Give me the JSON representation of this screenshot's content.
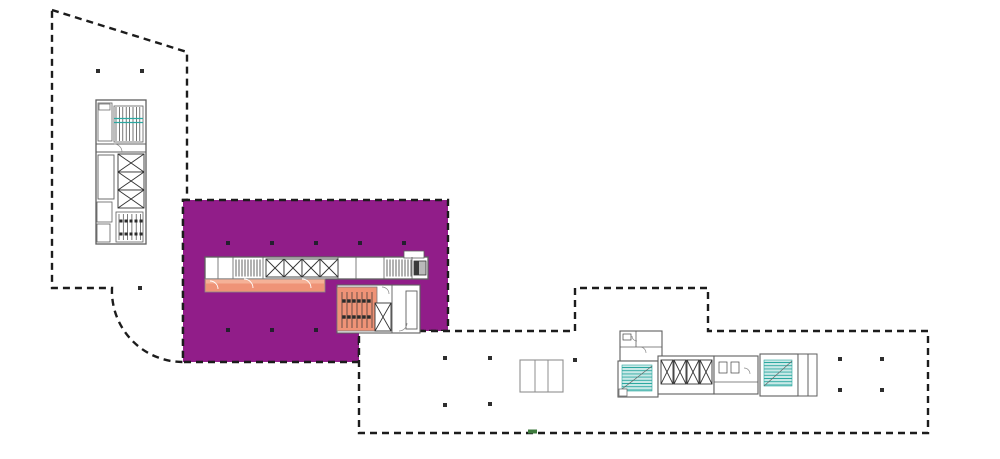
{
  "canvas": {
    "width": 1000,
    "height": 459,
    "background": "#ffffff"
  },
  "palette": {
    "purple": "#911d89",
    "orange": "#ef9377",
    "orange_light": "#f5b197",
    "teal": "#2ba8a0",
    "teal_light": "#c9e9e7",
    "wall": "#5f5f5f",
    "outline": "#1c1c1c",
    "column": "#2e2e2e",
    "green": "#3d7a3c",
    "lightline": "#8f8f8f"
  },
  "regions": {
    "west_wing": {
      "kind": "building-footprint",
      "fill": "#ffffff"
    },
    "highlighted_suite": {
      "kind": "highlight-zone",
      "fill": "#911d89"
    },
    "east_wing": {
      "kind": "building-footprint",
      "fill": "#ffffff"
    },
    "corridor_highlight": {
      "kind": "highlight-zone",
      "fill": "#ef9377"
    },
    "stall_room_highlight": {
      "kind": "highlight-zone",
      "fill": "#ef9377"
    }
  },
  "shapes": [
    {
      "name": "building-west-wing",
      "i": false,
      "t": "path",
      "d": "M52,10 L187,52 L187,200 L183,200 L183,362 A71,71 0 0 1 112,288 L52,288 Z",
      "f": "#ffffff",
      "k": "$outline",
      "sw": 2.4,
      "da": "7 5"
    },
    {
      "name": "highlight-zone-purple",
      "i": true,
      "t": "path",
      "d": "M183,200 L448,200 L448,331 L359,331 L359,362 L183,362 Z",
      "f": "$purple",
      "k": "$outline",
      "sw": 2.4,
      "da": "7 5"
    },
    {
      "name": "building-east-wing",
      "i": false,
      "t": "path",
      "d": "M359,331 L575,331 L575,288 L708,288 L708,331 L928,331 L928,433 L359,433 Z",
      "f": "#ffffff",
      "k": "$outline",
      "sw": 2.4,
      "da": "7 5"
    },
    {
      "name": "shaft-triplet",
      "i": false,
      "t": "rect",
      "x": 520,
      "y": 360,
      "w": 43,
      "h": 32,
      "f": "#ffffff",
      "k": "$lightline",
      "sw": 1.1
    },
    {
      "name": "shaft-triplet-divider",
      "i": false,
      "t": "line",
      "x1": 535,
      "y1": 360,
      "x2": 535,
      "y2": 392,
      "k": "$lightline",
      "sw": 1
    },
    {
      "name": "shaft-triplet-divider",
      "i": false,
      "t": "line",
      "x1": 548,
      "y1": 360,
      "x2": 548,
      "y2": 392,
      "k": "$lightline",
      "sw": 1
    },
    {
      "name": "central-core-band",
      "i": false,
      "t": "rect",
      "x": 205,
      "y": 257,
      "w": 223,
      "h": 22,
      "f": "#ffffff",
      "k": "$wall",
      "sw": 1.3
    },
    {
      "name": "central-core-tab",
      "i": false,
      "t": "rect",
      "x": 404,
      "y": 251,
      "w": 20,
      "h": 7,
      "f": "#ffffff",
      "k": "$wall",
      "sw": 0.8
    },
    {
      "name": "core-partition",
      "i": false,
      "t": "line",
      "x1": 218,
      "y1": 257,
      "x2": 218,
      "y2": 279,
      "k": "$wall",
      "sw": 0.8
    },
    {
      "name": "core-partition",
      "i": false,
      "t": "line",
      "x1": 233,
      "y1": 257,
      "x2": 233,
      "y2": 279,
      "k": "$wall",
      "sw": 0.8
    },
    {
      "name": "core-partition",
      "i": false,
      "t": "line",
      "x1": 263,
      "y1": 257,
      "x2": 263,
      "y2": 279,
      "k": "$wall",
      "sw": 0.8
    },
    {
      "name": "core-partition",
      "i": false,
      "t": "line",
      "x1": 338,
      "y1": 257,
      "x2": 338,
      "y2": 279,
      "k": "$wall",
      "sw": 0.8
    },
    {
      "name": "core-partition",
      "i": false,
      "t": "line",
      "x1": 356,
      "y1": 257,
      "x2": 356,
      "y2": 279,
      "k": "$wall",
      "sw": 0.8
    },
    {
      "name": "core-partition",
      "i": false,
      "t": "line",
      "x1": 384,
      "y1": 257,
      "x2": 384,
      "y2": 279,
      "k": "$wall",
      "sw": 0.8
    },
    {
      "name": "core-partition",
      "i": false,
      "t": "line",
      "x1": 412,
      "y1": 257,
      "x2": 412,
      "y2": 279,
      "k": "$wall",
      "sw": 0.8
    },
    {
      "name": "stair-hatch",
      "i": false,
      "t": "vl",
      "x": 236,
      "y": 259.5,
      "h": 17,
      "n": 9,
      "s": 3,
      "k": "#3c3c3c",
      "sw": 0.8
    },
    {
      "name": "elevator-cell",
      "i": false,
      "t": "xr",
      "x": 266,
      "y": 259,
      "w": 18,
      "h": 18,
      "f": "#ffffff",
      "k": "#333333",
      "sw": 0.9
    },
    {
      "name": "elevator-cell",
      "i": false,
      "t": "xr",
      "x": 284,
      "y": 259,
      "w": 18,
      "h": 18,
      "f": "#ffffff",
      "k": "#333333",
      "sw": 0.9
    },
    {
      "name": "elevator-cell",
      "i": false,
      "t": "xr",
      "x": 302,
      "y": 259,
      "w": 18,
      "h": 18,
      "f": "#ffffff",
      "k": "#333333",
      "sw": 0.9
    },
    {
      "name": "elevator-cell",
      "i": false,
      "t": "xr",
      "x": 320,
      "y": 259,
      "w": 18,
      "h": 18,
      "f": "#ffffff",
      "k": "#333333",
      "sw": 0.9
    },
    {
      "name": "stair-hatch",
      "i": false,
      "t": "vl",
      "x": 387,
      "y": 259.5,
      "h": 17,
      "n": 9,
      "s": 3,
      "k": "#3c3c3c",
      "sw": 0.8
    },
    {
      "name": "service-shaft",
      "i": false,
      "t": "rect",
      "x": 414,
      "y": 261,
      "w": 12,
      "h": 14,
      "f": "#b9b9b9",
      "k": "#333333",
      "sw": 0.8
    },
    {
      "name": "service-shaft-dark",
      "i": false,
      "t": "rect",
      "x": 414,
      "y": 261,
      "w": 5,
      "h": 14,
      "f": "#3a3a3a"
    },
    {
      "name": "corridor-highlight-orange",
      "i": true,
      "t": "rect",
      "x": 205,
      "y": 279,
      "w": 120,
      "h": 13,
      "f": "$orange",
      "k": "#8a8a8a",
      "sw": 0.8
    },
    {
      "name": "corridor-highlight-light",
      "i": false,
      "t": "rect",
      "x": 206,
      "y": 279.5,
      "w": 118,
      "h": 4,
      "f": "$orange_light"
    },
    {
      "name": "door-arc",
      "i": false,
      "t": "path",
      "d": "M210,281 a8,8 0 0 1 8,8",
      "k": "#ffffff",
      "sw": 0.9
    },
    {
      "name": "door-arc",
      "i": false,
      "t": "path",
      "d": "M244,279 a9,9 0 0 1 9,9",
      "k": "#ffffff",
      "sw": 0.9
    },
    {
      "name": "door-arc",
      "i": false,
      "t": "path",
      "d": "M302,279 a9,9 0 0 1 9,9",
      "k": "#ffffff",
      "sw": 0.9
    },
    {
      "name": "lower-core-cluster",
      "i": false,
      "t": "rect",
      "x": 337,
      "y": 285,
      "w": 83,
      "h": 48,
      "f": "#ffffff",
      "k": "$wall",
      "sw": 1.1
    },
    {
      "name": "stall-room-highlight-orange",
      "i": true,
      "t": "rect",
      "x": 337,
      "y": 287,
      "w": 40,
      "h": 44,
      "f": "$orange",
      "k": "#7a7a7a",
      "sw": 0.8
    },
    {
      "name": "stall-partitions",
      "i": false,
      "t": "vl",
      "x": 342,
      "y": 292,
      "h": 36,
      "n": 7,
      "s": 5,
      "k": "#333333",
      "sw": 0.7
    },
    {
      "name": "stall-fixtures",
      "i": false,
      "t": "dots",
      "pts": [
        [
          344,
          301
        ],
        [
          349,
          301
        ],
        [
          354,
          301
        ],
        [
          359,
          301
        ],
        [
          364,
          301
        ],
        [
          369,
          301
        ],
        [
          344,
          317
        ],
        [
          349,
          317
        ],
        [
          354,
          317
        ],
        [
          359,
          317
        ],
        [
          364,
          317
        ],
        [
          369,
          317
        ]
      ],
      "s": 3.4,
      "f": "#2b2b2b"
    },
    {
      "name": "stair-shaft",
      "i": false,
      "t": "xr",
      "x": 375,
      "y": 303,
      "w": 16,
      "h": 28,
      "f": "#ffffff",
      "k": "#333333",
      "sw": 0.9
    },
    {
      "name": "core-partition",
      "i": false,
      "t": "line",
      "x1": 392,
      "y1": 285,
      "x2": 392,
      "y2": 333,
      "k": "$wall",
      "sw": 0.9
    },
    {
      "name": "core-corridor",
      "i": false,
      "t": "rect",
      "x": 406,
      "y": 291,
      "w": 11,
      "h": 38,
      "f": "#ffffff",
      "k": "$wall",
      "sw": 0.9
    },
    {
      "name": "door-arc",
      "i": false,
      "t": "path",
      "d": "M382,287 a7,7 0 0 1 7,7",
      "k": "#888888",
      "sw": 0.7
    },
    {
      "name": "door-arc",
      "i": false,
      "t": "path",
      "d": "M399,331 a8,8 0 0 0 8,-8",
      "k": "#888888",
      "sw": 0.7
    },
    {
      "name": "west-core",
      "i": false,
      "t": "rect",
      "x": 96,
      "y": 100,
      "w": 50,
      "h": 144,
      "f": "#ffffff",
      "k": "$wall",
      "sw": 1.3
    },
    {
      "name": "core-partition",
      "i": false,
      "t": "line",
      "x1": 96,
      "y1": 144,
      "x2": 146,
      "y2": 144,
      "k": "$wall",
      "sw": 0.9
    },
    {
      "name": "core-partition",
      "i": false,
      "t": "line",
      "x1": 96,
      "y1": 152,
      "x2": 146,
      "y2": 152,
      "k": "$wall",
      "sw": 0.9
    },
    {
      "name": "west-core-room",
      "i": false,
      "t": "rect",
      "x": 98,
      "y": 103,
      "w": 14,
      "h": 38,
      "k": "$wall",
      "sw": 0.8
    },
    {
      "name": "west-core-cabinet",
      "i": false,
      "t": "rect",
      "x": 99,
      "y": 104,
      "w": 11,
      "h": 6,
      "k": "$wall",
      "sw": 0.7
    },
    {
      "name": "stair-room",
      "i": false,
      "t": "rect",
      "x": 114,
      "y": 106,
      "w": 29,
      "h": 36,
      "k": "$wall",
      "sw": 0.8
    },
    {
      "name": "stair-hatch",
      "i": false,
      "t": "vl",
      "x": 116,
      "y": 107,
      "h": 34,
      "n": 8,
      "s": 3.4,
      "k": "#3c3c3c",
      "sw": 0.7
    },
    {
      "name": "stair-tread-teal",
      "i": false,
      "t": "line",
      "x1": 114,
      "y1": 118.5,
      "x2": 143,
      "y2": 118.5,
      "k": "$teal",
      "sw": 1.3
    },
    {
      "name": "stair-tread-teal",
      "i": false,
      "t": "line",
      "x1": 114,
      "y1": 122.5,
      "x2": 143,
      "y2": 122.5,
      "k": "$teal",
      "sw": 1.3
    },
    {
      "name": "door-arc",
      "i": false,
      "t": "path",
      "d": "M114,144 a8,8 0 0 1 8,8",
      "k": "#888888",
      "sw": 0.7
    },
    {
      "name": "west-core-room",
      "i": false,
      "t": "rect",
      "x": 98,
      "y": 155,
      "w": 16,
      "h": 44,
      "k": "$wall",
      "sw": 0.9
    },
    {
      "name": "elevator-cell",
      "i": false,
      "t": "xr",
      "x": 118,
      "y": 154,
      "w": 26,
      "h": 18,
      "f": "#ffffff",
      "k": "#333333",
      "sw": 0.9
    },
    {
      "name": "elevator-cell",
      "i": false,
      "t": "xr",
      "x": 118,
      "y": 172,
      "w": 26,
      "h": 18,
      "f": "#ffffff",
      "k": "#333333",
      "sw": 0.9
    },
    {
      "name": "elevator-cell",
      "i": false,
      "t": "xr",
      "x": 118,
      "y": 190,
      "w": 26,
      "h": 18,
      "f": "#ffffff",
      "k": "#333333",
      "sw": 0.9
    },
    {
      "name": "west-core-room",
      "i": false,
      "t": "rect",
      "x": 97,
      "y": 202,
      "w": 15,
      "h": 20,
      "k": "$wall",
      "sw": 0.8
    },
    {
      "name": "west-core-room",
      "i": false,
      "t": "rect",
      "x": 97,
      "y": 224,
      "w": 13,
      "h": 18,
      "k": "$wall",
      "sw": 0.8
    },
    {
      "name": "stall-room",
      "i": false,
      "t": "rect",
      "x": 116,
      "y": 212,
      "w": 27,
      "h": 30,
      "k": "$wall",
      "sw": 0.8
    },
    {
      "name": "stall-partitions",
      "i": false,
      "t": "vl",
      "x": 119,
      "y": 214,
      "h": 26,
      "n": 6,
      "s": 4.3,
      "k": "#444444",
      "sw": 0.7
    },
    {
      "name": "stall-fixtures",
      "i": false,
      "t": "dots",
      "pts": [
        [
          121,
          221
        ],
        [
          126,
          221
        ],
        [
          131,
          221
        ],
        [
          136,
          221
        ],
        [
          141,
          221
        ],
        [
          121,
          234
        ],
        [
          126,
          234
        ],
        [
          131,
          234
        ],
        [
          136,
          234
        ],
        [
          141,
          234
        ]
      ],
      "s": 3,
      "f": "#2b2b2b"
    },
    {
      "name": "east-core-rooms",
      "i": false,
      "t": "rect",
      "x": 620,
      "y": 331,
      "w": 42,
      "h": 30,
      "f": "#ffffff",
      "k": "$wall",
      "sw": 1.1
    },
    {
      "name": "core-partition",
      "i": false,
      "t": "line",
      "x1": 636,
      "y1": 331,
      "x2": 636,
      "y2": 347,
      "k": "$wall",
      "sw": 0.8
    },
    {
      "name": "core-partition",
      "i": false,
      "t": "line",
      "x1": 620,
      "y1": 347,
      "x2": 662,
      "y2": 347,
      "k": "$wall",
      "sw": 0.8
    },
    {
      "name": "fixture",
      "i": false,
      "t": "rect",
      "x": 623,
      "y": 334,
      "w": 8,
      "h": 6,
      "k": "#444444",
      "sw": 0.7
    },
    {
      "name": "door-arc",
      "i": false,
      "t": "path",
      "d": "M640,347 a6,6 0 0 1 6,6",
      "k": "#888888",
      "sw": 0.7
    },
    {
      "name": "door-arc",
      "i": false,
      "t": "path",
      "d": "M632,336 a5,5 0 0 0 5,5",
      "k": "#888888",
      "sw": 0.7
    },
    {
      "name": "stair-room",
      "i": false,
      "t": "rect",
      "x": 618,
      "y": 361,
      "w": 40,
      "h": 36,
      "f": "#ffffff",
      "k": "$wall",
      "sw": 1.1
    },
    {
      "name": "stair-teal-block",
      "i": false,
      "t": "rect",
      "x": 622,
      "y": 365,
      "w": 30,
      "h": 26,
      "f": "$teal_light",
      "k": "$teal",
      "sw": 0.6
    },
    {
      "name": "stair-treads-teal",
      "i": false,
      "t": "hl",
      "x": 622,
      "y": 367.5,
      "w": 30,
      "n": 8,
      "s": 3.2,
      "k": "$teal",
      "sw": 0.9
    },
    {
      "name": "stair-diagonal",
      "i": false,
      "t": "line",
      "x1": 622,
      "y1": 389,
      "x2": 652,
      "y2": 366,
      "k": "#666666",
      "sw": 0.7
    },
    {
      "name": "east-core-closet",
      "i": false,
      "t": "rect",
      "x": 619,
      "y": 389,
      "w": 8,
      "h": 7,
      "f": "#ffffff",
      "k": "$wall",
      "sw": 0.7
    },
    {
      "name": "elevator-lobby",
      "i": false,
      "t": "rect",
      "x": 658,
      "y": 356,
      "w": 56,
      "h": 38,
      "f": "#ffffff",
      "k": "$wall",
      "sw": 1.1
    },
    {
      "name": "elevator-cell",
      "i": false,
      "t": "xr",
      "x": 661,
      "y": 360,
      "w": 12,
      "h": 24,
      "f": "#ffffff",
      "k": "#333333",
      "sw": 0.9
    },
    {
      "name": "elevator-cell",
      "i": false,
      "t": "xr",
      "x": 674,
      "y": 360,
      "w": 12,
      "h": 24,
      "f": "#ffffff",
      "k": "#333333",
      "sw": 0.9
    },
    {
      "name": "elevator-cell",
      "i": false,
      "t": "xr",
      "x": 687,
      "y": 360,
      "w": 12,
      "h": 24,
      "f": "#ffffff",
      "k": "#333333",
      "sw": 0.9
    },
    {
      "name": "elevator-cell",
      "i": false,
      "t": "xr",
      "x": 700,
      "y": 360,
      "w": 12,
      "h": 24,
      "f": "#ffffff",
      "k": "#333333",
      "sw": 0.9
    },
    {
      "name": "restroom",
      "i": false,
      "t": "rect",
      "x": 714,
      "y": 356,
      "w": 44,
      "h": 38,
      "f": "#ffffff",
      "k": "$wall",
      "sw": 1.1
    },
    {
      "name": "core-partition",
      "i": false,
      "t": "line",
      "x1": 714,
      "y1": 382,
      "x2": 758,
      "y2": 382,
      "k": "$wall",
      "sw": 0.7
    },
    {
      "name": "fixture",
      "i": false,
      "t": "rect",
      "x": 719,
      "y": 362,
      "w": 8,
      "h": 11,
      "k": "#444444",
      "sw": 0.7
    },
    {
      "name": "fixture",
      "i": false,
      "t": "rect",
      "x": 731,
      "y": 362,
      "w": 8,
      "h": 11,
      "k": "#444444",
      "sw": 0.7
    },
    {
      "name": "door-arc",
      "i": false,
      "t": "path",
      "d": "M744,368 a6,6 0 0 1 6,6",
      "k": "#888888",
      "sw": 0.7
    },
    {
      "name": "stair-room",
      "i": false,
      "t": "rect",
      "x": 760,
      "y": 354,
      "w": 38,
      "h": 42,
      "f": "#ffffff",
      "k": "$wall",
      "sw": 1.1
    },
    {
      "name": "stair-teal-block",
      "i": false,
      "t": "rect",
      "x": 764,
      "y": 360,
      "w": 28,
      "h": 26,
      "f": "$teal_light",
      "k": "$teal",
      "sw": 0.6
    },
    {
      "name": "stair-treads-teal",
      "i": false,
      "t": "hl",
      "x": 764,
      "y": 362.5,
      "w": 28,
      "n": 8,
      "s": 3.2,
      "k": "$teal",
      "sw": 0.9
    },
    {
      "name": "stair-diagonal",
      "i": false,
      "t": "line",
      "x1": 764,
      "y1": 386,
      "x2": 792,
      "y2": 361,
      "k": "#666666",
      "sw": 0.7
    },
    {
      "name": "shaft-column",
      "i": false,
      "t": "rect",
      "x": 798,
      "y": 354,
      "w": 10,
      "h": 42,
      "f": "#ffffff",
      "k": "$wall",
      "sw": 1
    },
    {
      "name": "shaft-column",
      "i": false,
      "t": "rect",
      "x": 808,
      "y": 354,
      "w": 9,
      "h": 42,
      "f": "#ffffff",
      "k": "$wall",
      "sw": 1
    },
    {
      "name": "column-dots-west",
      "i": false,
      "t": "dots",
      "pts": [
        [
          98,
          71
        ],
        [
          142,
          71
        ],
        [
          140,
          288
        ]
      ],
      "s": 4,
      "f": "$column"
    },
    {
      "name": "column-dots-purple",
      "i": false,
      "t": "dots",
      "pts": [
        [
          228,
          243
        ],
        [
          272,
          243
        ],
        [
          316,
          243
        ],
        [
          360,
          243
        ],
        [
          404,
          243
        ],
        [
          228,
          330
        ],
        [
          272,
          330
        ],
        [
          316,
          330
        ]
      ],
      "s": 4,
      "f": "#241f2e"
    },
    {
      "name": "column-dots-east",
      "i": false,
      "t": "dots",
      "pts": [
        [
          445,
          358
        ],
        [
          490,
          358
        ],
        [
          445,
          405
        ],
        [
          490,
          404
        ],
        [
          575,
          360
        ],
        [
          840,
          359
        ],
        [
          882,
          359
        ],
        [
          840,
          390
        ],
        [
          882,
          390
        ]
      ],
      "s": 4,
      "f": "$column"
    },
    {
      "name": "green-tick",
      "i": false,
      "t": "rect",
      "x": 528,
      "y": 429.5,
      "w": 9,
      "h": 4,
      "f": "$green"
    }
  ]
}
